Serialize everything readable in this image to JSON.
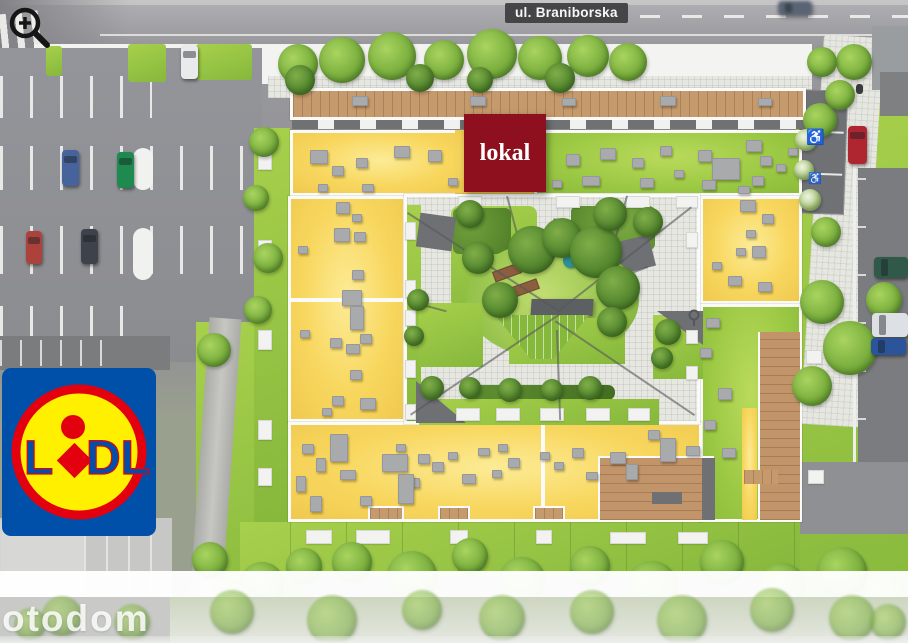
{
  "labels": {
    "street": "ul. Braniborska",
    "unit": "lokal",
    "watermark": "otodom",
    "lidl_l": "L",
    "lidl_dl": "DL"
  },
  "icons": {
    "zoom_in": "magnifier-plus",
    "disabled_parking": "wheelchair",
    "courtyard_lamp": "lamp"
  },
  "symbols": {
    "disabled_parking": "♿"
  },
  "colors": {
    "unit_highlight": "#8e0f1e",
    "street_badge": "#3d3d40",
    "roof_available": "#f8d75f",
    "roof_green": "#9cc944",
    "lawn": "#8cc043",
    "wood_deck": "#c59a6c",
    "lidl_blue": "#0050aa",
    "lidl_yellow": "#fff000",
    "lidl_red": "#e3000f"
  },
  "cars": {
    "lot_blue": "#47639c",
    "lot_green": "#1f8a4f",
    "lot_white": "#e9eaec",
    "lot_red": "#ac423b",
    "lot_dark": "#3e424a",
    "street_red": "#b02630",
    "right_darkgreen": "#31594a",
    "right_white": "#dde0e4",
    "right_blue": "#2c549b",
    "road_moving": "#5a6374"
  }
}
